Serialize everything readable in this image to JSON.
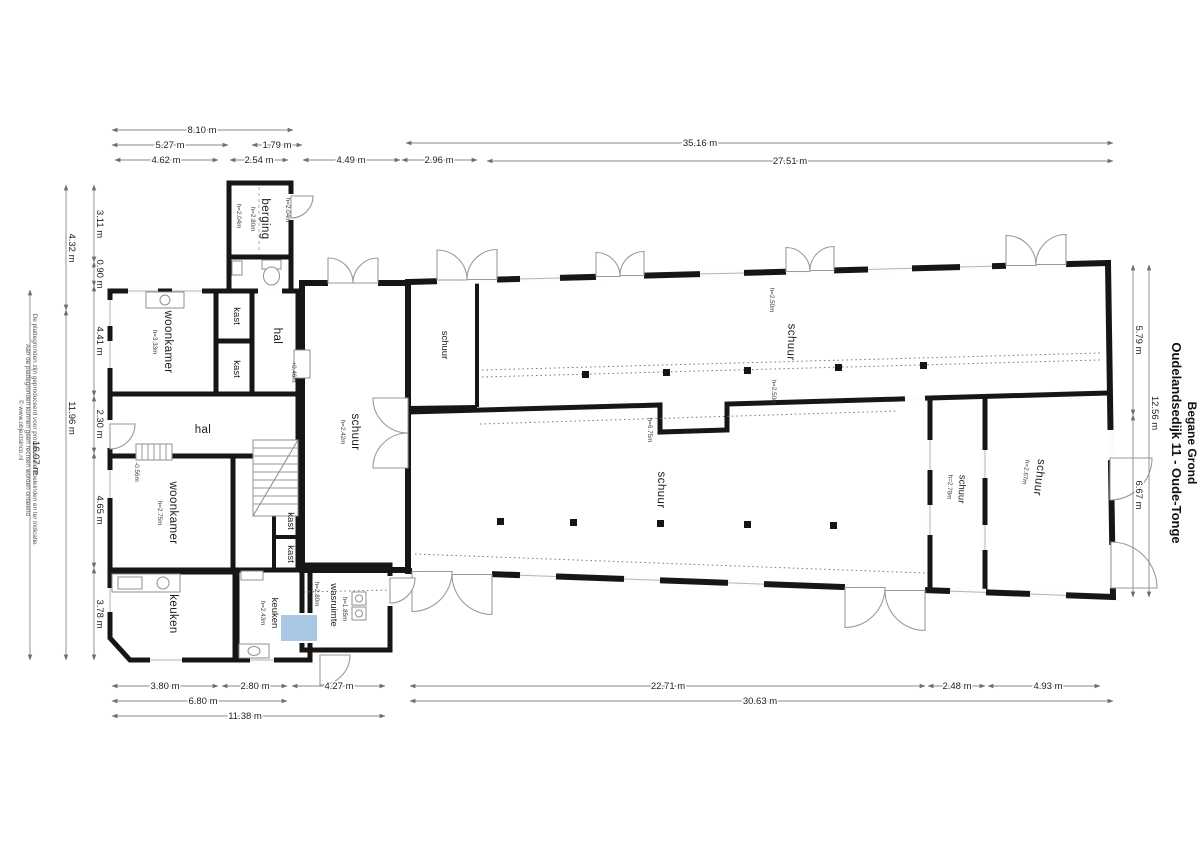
{
  "title": {
    "address": "Oudelandsedijk 11 - Oude-Tonge",
    "floor": "Begane Grond"
  },
  "disclaimer": {
    "line1": "De plattegronden zijn geproduceerd voor promotionele doeleinden en ter indicatie.",
    "line2": "Aan de plattegronden kunnen geen rechten worden ontleend",
    "line3": "© www.objectsinco.nl"
  },
  "rooms": {
    "berging": {
      "name": "berging",
      "height": "h=2.80m",
      "side_height_left": "h=2.04m",
      "side_height_right": "h=2.04m"
    },
    "woonkamer_boven": {
      "name": "woonkamer",
      "height": "h=3.33m"
    },
    "kast1": {
      "name": "kast"
    },
    "kast2": {
      "name": "kast"
    },
    "kast3": {
      "name": "kast"
    },
    "kast4": {
      "name": "kast"
    },
    "hal_boven": {
      "name": "hal",
      "level": "+0.46m"
    },
    "hal_midden": {
      "name": "hal",
      "level": "-0.56m"
    },
    "woonkamer_onder": {
      "name": "woonkamer",
      "height": "h=2.75m"
    },
    "keuken_links": {
      "name": "keuken"
    },
    "keuken_rechts": {
      "name": "keuken",
      "height": "h=2.43m"
    },
    "wasruimte": {
      "name": "wasruimte",
      "height": "h=1.85m",
      "height2": "h=2.80m"
    },
    "schuur_links": {
      "name": "schuur",
      "height": "h=2.42m"
    },
    "schuur_klein": {
      "name": "schuur"
    },
    "schuur_boven": {
      "name": "schuur",
      "height_a": "h=2.50m",
      "height_b": "h=2.50m"
    },
    "schuur_midden": {
      "name": "schuur",
      "height": "h=6.75m"
    },
    "schuur_smal": {
      "name": "schuur",
      "height": "h=2.78m"
    },
    "schuur_rechts": {
      "name": "schuur",
      "height": "h=2.67m"
    }
  },
  "dimensions": {
    "top": [
      "8.10 m",
      "5.27 m",
      "1.79 m",
      "35.16 m",
      "4.62 m",
      "2.54 m",
      "4.49 m",
      "2.96 m",
      "27.51 m"
    ],
    "left": [
      "3.11 m",
      "0.90 m",
      "4.41 m",
      "2.30 m",
      "4.65 m",
      "3.78 m",
      "4.32 m",
      "11.96 m",
      "16.07 m"
    ],
    "right": [
      "5.79 m",
      "6.67 m",
      "12.56 m"
    ],
    "bottom": [
      "3.80 m",
      "2.80 m",
      "4.27 m",
      "22.71 m",
      "2.48 m",
      "4.93 m",
      "6.80 m",
      "30.63 m",
      "11.38 m"
    ]
  },
  "colors": {
    "room_beige": "#e7decb",
    "room_tan": "#efd9a5",
    "room_orange": "#f3a94a",
    "room_brown": "#a89f87",
    "room_green": "#c6cdbd",
    "room_blue": "#aac7e3",
    "wall": "#161616"
  }
}
